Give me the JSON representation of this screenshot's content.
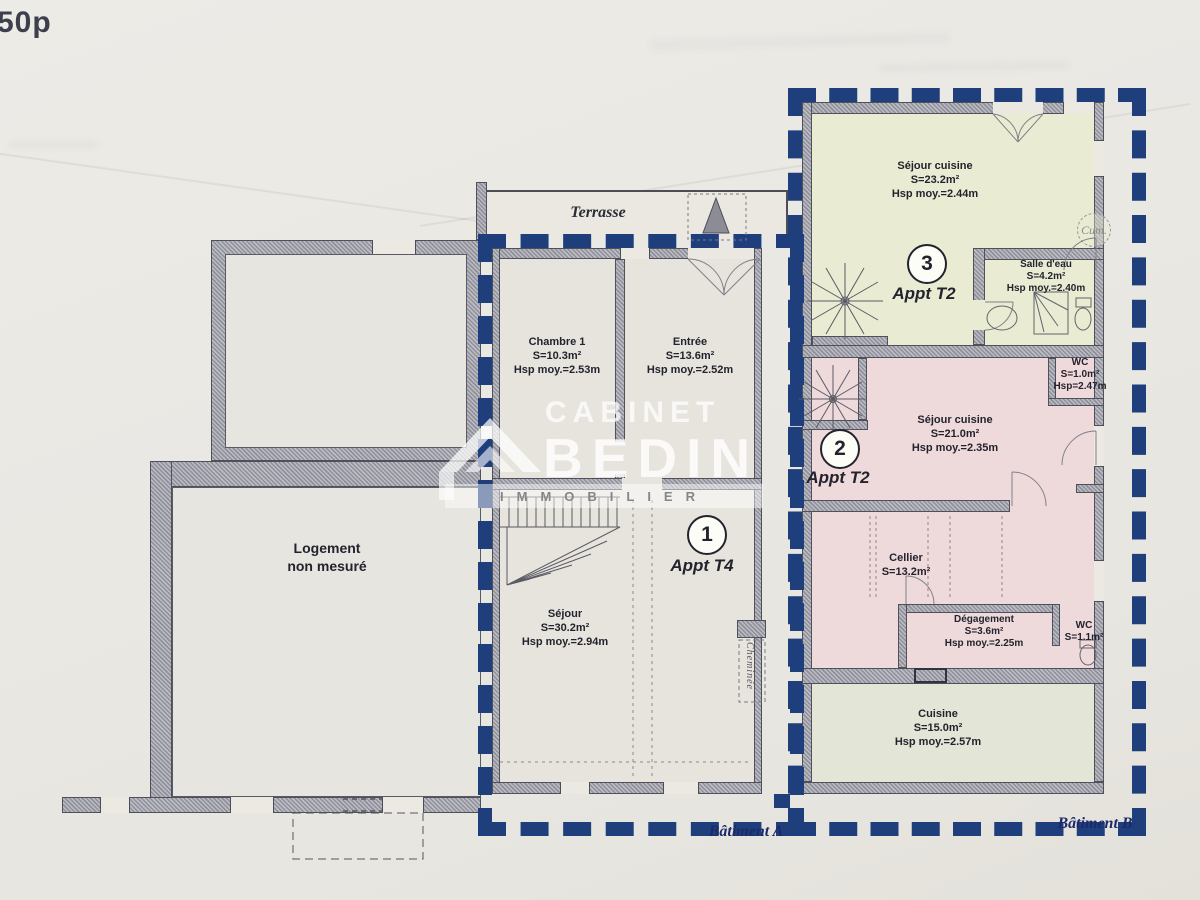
{
  "page": {
    "corner_note": "50p"
  },
  "colors": {
    "boundary_blue": "#1f3e7c",
    "wall_gray": "#9a9ba3",
    "apt3_fill": "#e9ecd3",
    "apt2_fill": "#efdadb",
    "cuisine_fill": "#e3e5d6",
    "neutral_room_fill": "#e6e4dd",
    "label_ink": "#23232e",
    "batiment_ink": "#1c2a6a"
  },
  "watermark": {
    "brand_top": "CABINET",
    "brand_main": "BEDIN",
    "brand_sub": "IMMOBILIER"
  },
  "plan": {
    "terrasse": "Terrasse",
    "cheminee": "Cheminée",
    "cumulus": "Cum.",
    "batiment_a": "Bâtiment A",
    "batiment_b": "Bâtiment B",
    "logement": {
      "line1": "Logement",
      "line2": "non mesuré"
    },
    "apartments": {
      "a1": {
        "number": "1",
        "label": "Appt T4"
      },
      "a2": {
        "number": "2",
        "label": "Appt T2"
      },
      "a3": {
        "number": "3",
        "label": "Appt T2"
      }
    },
    "rooms": {
      "chambre1": {
        "name": "Chambre 1",
        "area": "S=10.3m²",
        "height": "Hsp moy.=2.53m"
      },
      "entree": {
        "name": "Entrée",
        "area": "S=13.6m²",
        "height": "Hsp moy.=2.52m"
      },
      "sejour_t4": {
        "name": "Séjour",
        "area": "S=30.2m²",
        "height": "Hsp moy.=2.94m"
      },
      "sejour_cuisine_a3": {
        "name": "Séjour cuisine",
        "area": "S=23.2m²",
        "height": "Hsp moy.=2.44m"
      },
      "salle_eau": {
        "name": "Salle d'eau",
        "area": "S=4.2m²",
        "height": "Hsp moy.=2.40m"
      },
      "wc_a2": {
        "name": "WC",
        "area": "S=1.0m²",
        "height": "Hsp=2.47m"
      },
      "sejour_cuisine_a2": {
        "name": "Séjour cuisine",
        "area": "S=21.0m²",
        "height": "Hsp moy.=2.35m"
      },
      "cellier": {
        "name": "Cellier",
        "area": "S=13.2m²"
      },
      "degagement": {
        "name": "Dégagement",
        "area": "S=3.6m²",
        "height": "Hsp moy.=2.25m"
      },
      "wc_rdc": {
        "name": "WC",
        "area": "S=1.1m²"
      },
      "cuisine": {
        "name": "Cuisine",
        "area": "S=15.0m²",
        "height": "Hsp moy.=2.57m"
      }
    }
  }
}
